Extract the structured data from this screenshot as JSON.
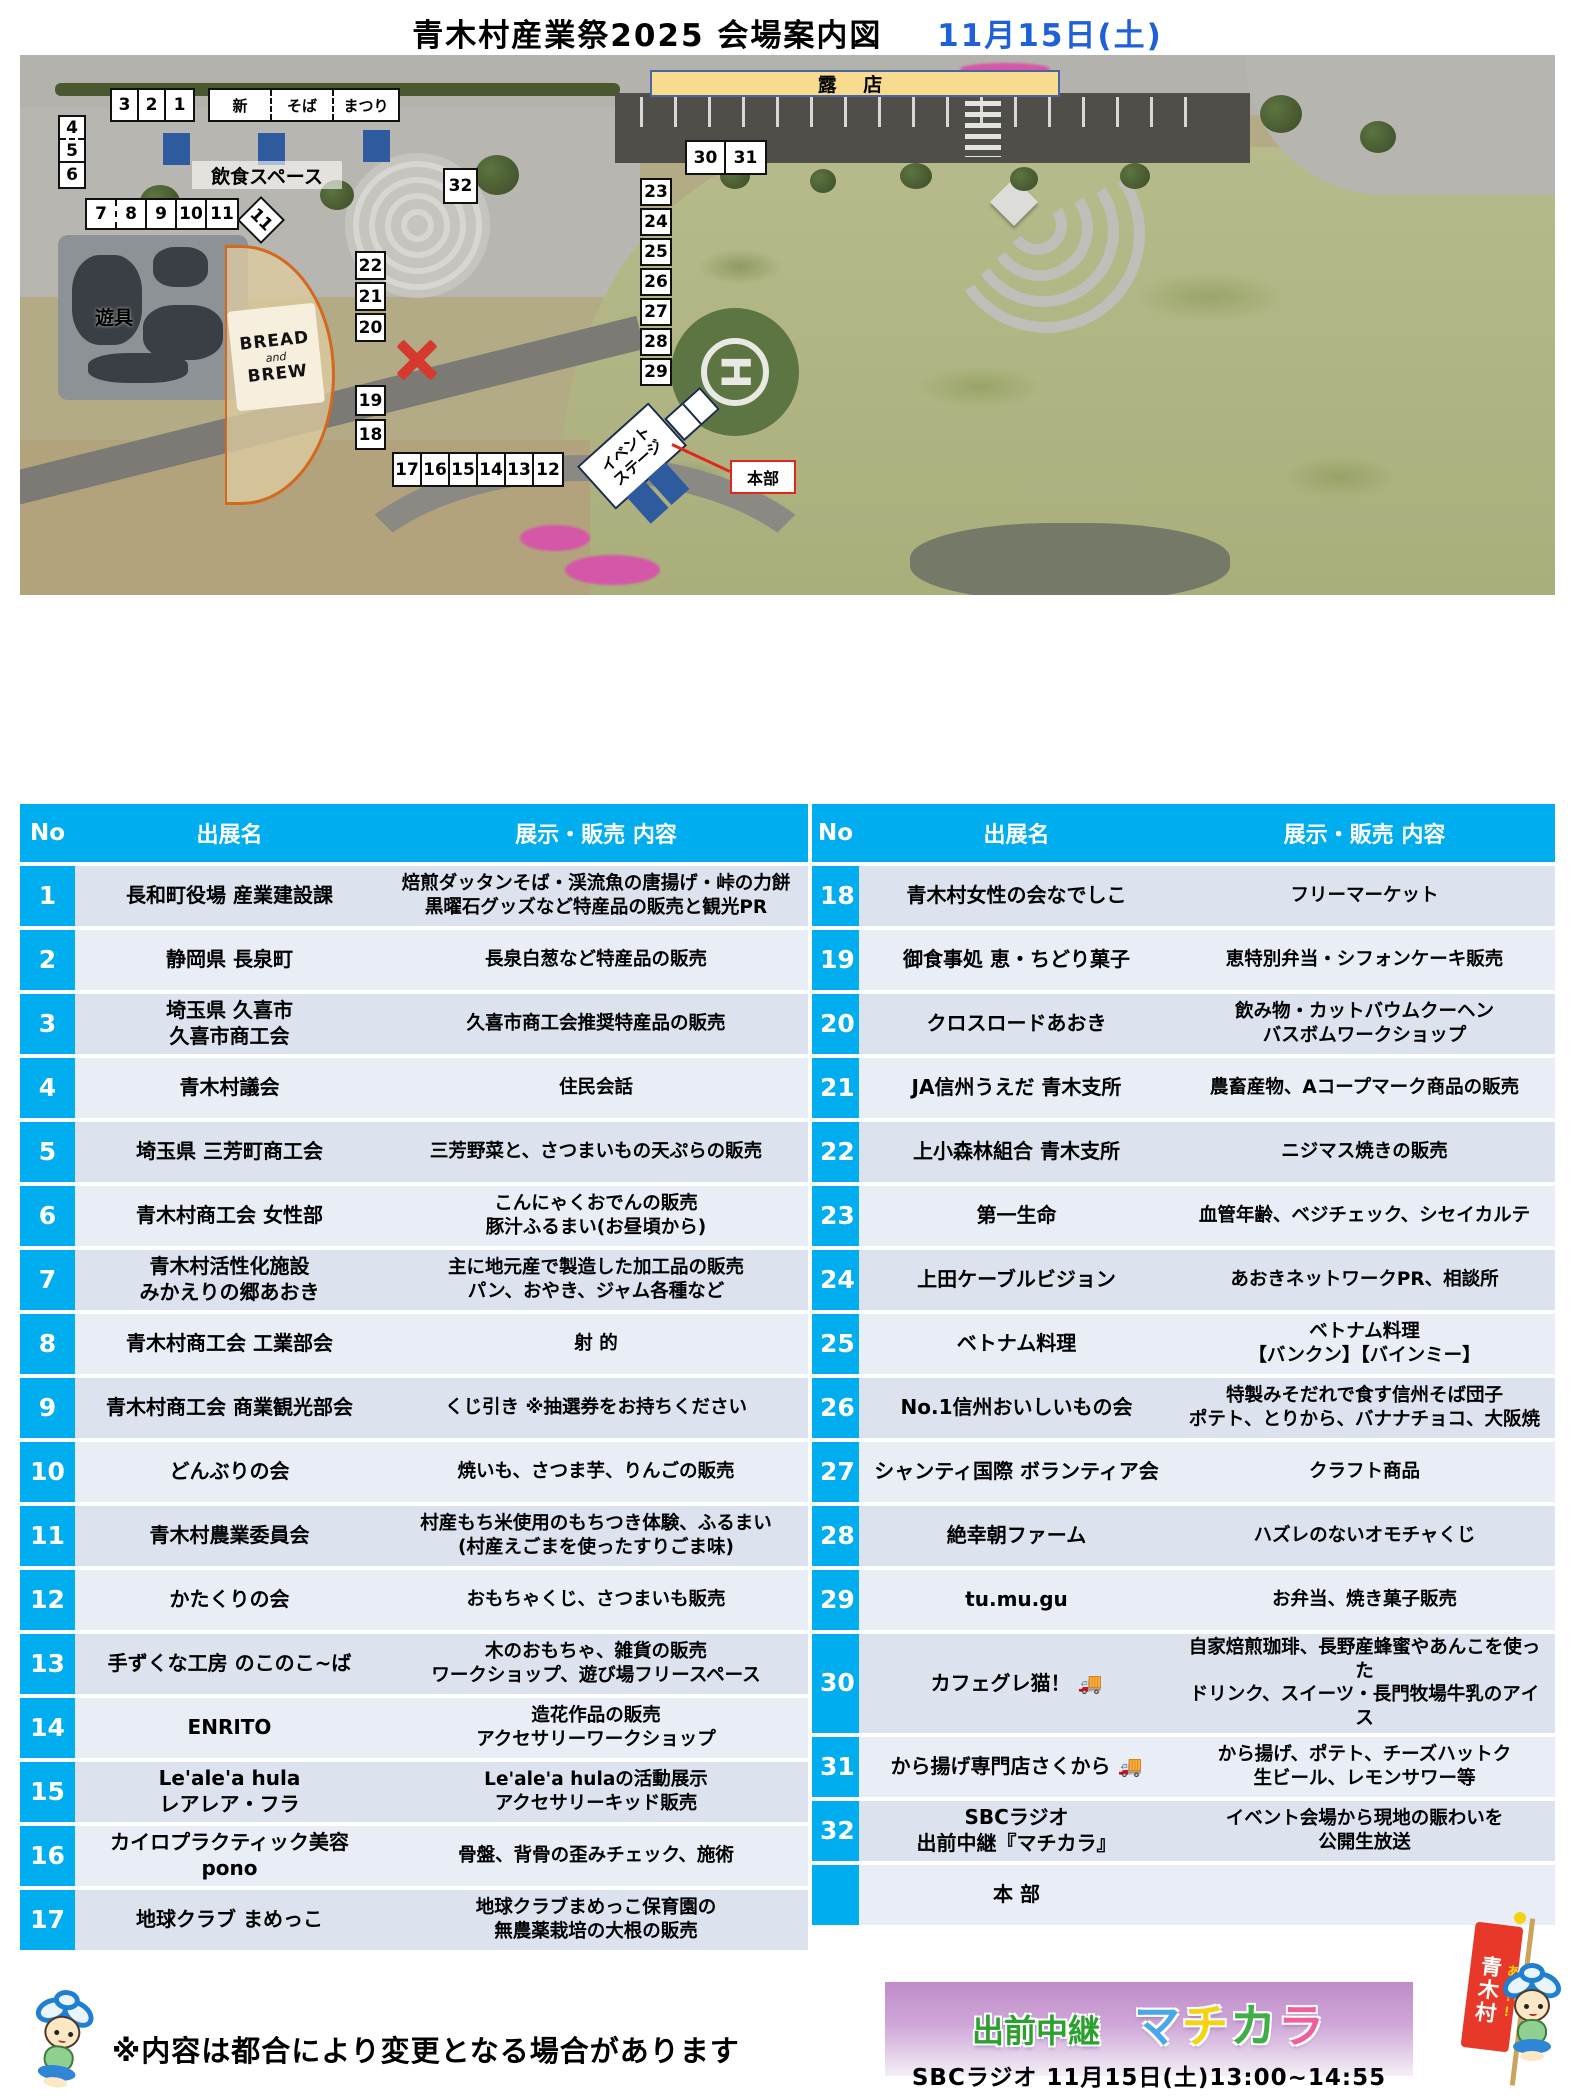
{
  "title": {
    "main": "青木村産業祭2025  会場案内図",
    "date": "11月15日(土)"
  },
  "colors": {
    "header_cyan": "#00aeef",
    "row_odd": "#dce3ef",
    "row_even": "#e9edf6",
    "date_blue": "#1f5fd8",
    "accent_red": "#e0271b",
    "roten_yellow": "#f8db8e",
    "booth_blue": "#2e5a9e",
    "banner_purple": "#bf8cc9"
  },
  "map": {
    "roten": "露 店",
    "inshoku": "飲食スペース",
    "yugu": "遊具",
    "bread": {
      "line1": "BREAD",
      "line2": "and",
      "line3": "BREW"
    },
    "stage": {
      "line1": "イベント",
      "line2": "ステージ"
    },
    "honbu": "本部",
    "heliport_letter": "H",
    "row321": [
      "3",
      "2",
      "1"
    ],
    "shinsoba": [
      "新",
      "そば",
      "まつり"
    ],
    "col456": [
      "4",
      "5",
      "6"
    ],
    "row7_11": [
      "7",
      "8",
      "9",
      "10",
      "11"
    ],
    "diamond11": "11",
    "box32": "32",
    "row30_31": [
      "30",
      "31"
    ],
    "col23_29": [
      "23",
      "24",
      "25",
      "26",
      "27",
      "28",
      "29"
    ],
    "col22_20": [
      "22",
      "21",
      "20"
    ],
    "col19_18": [
      "19",
      "18"
    ],
    "row17_12": [
      "17",
      "16",
      "15",
      "14",
      "13",
      "12"
    ]
  },
  "table": {
    "header": {
      "no": "No",
      "name": "出展名",
      "content": "展示・販売  内容"
    },
    "left_rows": [
      {
        "no": "1",
        "name": "長和町役場  産業建設課",
        "content": [
          "焙煎ダッタンそば・渓流魚の唐揚げ・峠の力餅",
          "黒曜石グッズなど特産品の販売と観光PR"
        ]
      },
      {
        "no": "2",
        "name": "静岡県  長泉町",
        "content": "長泉白葱など特産品の販売"
      },
      {
        "no": "3",
        "name": [
          "埼玉県  久喜市",
          "久喜市商工会"
        ],
        "content": "久喜市商工会推奨特産品の販売"
      },
      {
        "no": "4",
        "name": "青木村議会",
        "content": "住民会話"
      },
      {
        "no": "5",
        "name": "埼玉県  三芳町商工会",
        "content": "三芳野菜と、さつまいもの天ぷらの販売"
      },
      {
        "no": "6",
        "name": "青木村商工会  女性部",
        "content": [
          "こんにゃくおでんの販売",
          "豚汁ふるまい(お昼頃から)"
        ]
      },
      {
        "no": "7",
        "name": [
          "青木村活性化施設",
          "みかえりの郷あおき"
        ],
        "content": [
          "主に地元産で製造した加工品の販売",
          "パン、おやき、ジャム各種など"
        ]
      },
      {
        "no": "8",
        "name": "青木村商工会  工業部会",
        "content": "射  的"
      },
      {
        "no": "9",
        "name": "青木村商工会  商業観光部会",
        "content": "くじ引き  ※抽選券をお持ちください"
      },
      {
        "no": "10",
        "name": "どんぶりの会",
        "content": "焼いも、さつま芋、りんごの販売"
      },
      {
        "no": "11",
        "name": "青木村農業委員会",
        "content": [
          "村産もち米使用のもちつき体験、ふるまい",
          "(村産えごまを使ったすりごま味)"
        ]
      },
      {
        "no": "12",
        "name": "かたくりの会",
        "content": "おもちゃくじ、さつまいも販売"
      },
      {
        "no": "13",
        "name": "手ずくな工房  のこのこ~ば",
        "content": [
          "木のおもちゃ、雑貨の販売",
          "ワークショップ、遊び場フリースペース"
        ]
      },
      {
        "no": "14",
        "name": "ENRITO",
        "content": [
          "造花作品の販売",
          "アクセサリーワークショップ"
        ]
      },
      {
        "no": "15",
        "name": [
          "Le'ale'a hula",
          "レアレア・フラ"
        ],
        "content": [
          "Le'ale'a hulaの活動展示",
          "アクセサリーキッド販売"
        ]
      },
      {
        "no": "16",
        "name": [
          "カイロプラクティック美容",
          "pono"
        ],
        "content": "骨盤、背骨の歪みチェック、施術"
      },
      {
        "no": "17",
        "name": "地球クラブ  まめっこ",
        "content": [
          "地球クラブまめっこ保育園の",
          "無農薬栽培の大根の販売"
        ]
      }
    ],
    "right_rows": [
      {
        "no": "18",
        "name": "青木村女性の会なでしこ",
        "content": "フリーマーケット"
      },
      {
        "no": "19",
        "name": "御食事処  恵・ちどり菓子",
        "content": "恵特別弁当・シフォンケーキ販売"
      },
      {
        "no": "20",
        "name": "クロスロードあおき",
        "content": [
          "飲み物・カットバウムクーヘン",
          "バスボムワークショップ"
        ]
      },
      {
        "no": "21",
        "name": "JA信州うえだ  青木支所",
        "content": "農畜産物、Aコープマーク商品の販売"
      },
      {
        "no": "22",
        "name": "上小森林組合  青木支所",
        "content": "ニジマス焼きの販売"
      },
      {
        "no": "23",
        "name": "第一生命",
        "content": "血管年齢、ベジチェック、シセイカルテ"
      },
      {
        "no": "24",
        "name": "上田ケーブルビジョン",
        "content": "あおきネットワークPR、相談所"
      },
      {
        "no": "25",
        "name": "ベトナム料理",
        "content": [
          "ベトナム料理",
          "【バンクン】【バインミー】"
        ]
      },
      {
        "no": "26",
        "name": "No.1信州おいしいもの会",
        "content": [
          "特製みそだれで食す信州そば団子",
          "ポテト、とりから、バナナチョコ、大阪焼"
        ]
      },
      {
        "no": "27",
        "name": "シャンティ国際  ボランティア会",
        "content": "クラフト商品"
      },
      {
        "no": "28",
        "name": "絶幸朝ファーム",
        "content": "ハズレのないオモチャくじ"
      },
      {
        "no": "29",
        "name": "tu.mu.gu",
        "content": "お弁当、焼き菓子販売"
      },
      {
        "no": "30",
        "name": "カフェグレ猫！  🚚",
        "content": [
          "自家焙煎珈琲、長野産蜂蜜やあんこを使った",
          "ドリンク、スイーツ・長門牧場牛乳のアイス"
        ]
      },
      {
        "no": "31",
        "name": "から揚げ専門店さくから  🚚",
        "content": [
          "から揚げ、ポテト、チーズハットク",
          "生ビール、レモンサワー等"
        ]
      },
      {
        "no": "32",
        "name": [
          "SBCラジオ",
          "出前中継『マチカラ』"
        ],
        "content": [
          "イベント会場から現地の賑わいを",
          "公開生放送"
        ]
      },
      {
        "no": "",
        "name": "本  部",
        "content": ""
      }
    ]
  },
  "footer": {
    "note": "※内容は都合により変更となる場合があります",
    "banner": {
      "label": "出前中継",
      "chars": [
        "マ",
        "チ",
        "カ",
        "ラ"
      ],
      "subtitle": "SBCラジオ  11月15日(土)13:00~14:55"
    },
    "flag": {
      "top": "あっ!!",
      "bottom": "青木村"
    }
  }
}
